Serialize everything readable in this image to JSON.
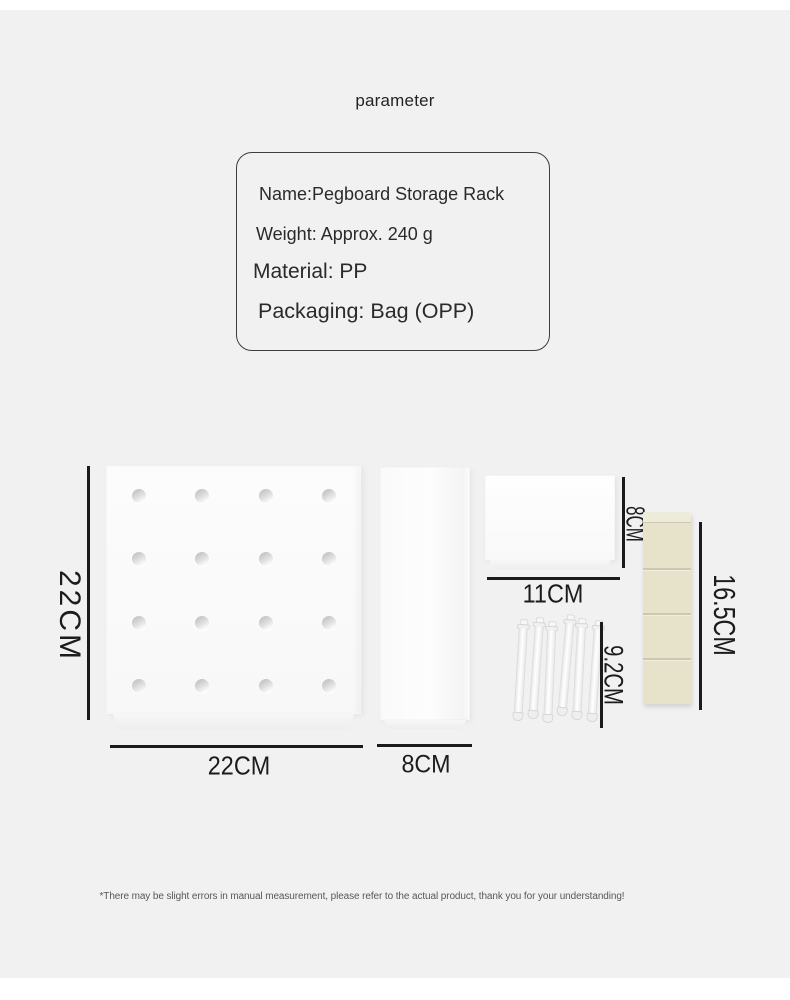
{
  "page": {
    "title": "parameter",
    "background": "#f1f1f2",
    "dimension_line_color": "#1b1b1b",
    "disclaimer": "*There may be slight errors in manual measurement, please refer to the actual product, thank you for your understanding!"
  },
  "spec_box": {
    "lines": [
      "Name:Pegboard Storage Rack",
      "Weight: Approx. 240 g",
      "Material: PP",
      "Packaging: Bag (OPP)"
    ]
  },
  "diagram": {
    "pegboard": {
      "height_label": "22CM",
      "width_label": "22CM",
      "hole_rows": 4,
      "hole_cols": 4
    },
    "side_panel": {
      "width_label": "8CM"
    },
    "small_box": {
      "height_label": "8CM",
      "width_label": "11CM"
    },
    "pegs": {
      "count": 6,
      "height_label": "9.2CM"
    },
    "adhesive_tape": {
      "height_label": "16.5CM",
      "segments": 4,
      "color": "#e7e3cb"
    }
  }
}
